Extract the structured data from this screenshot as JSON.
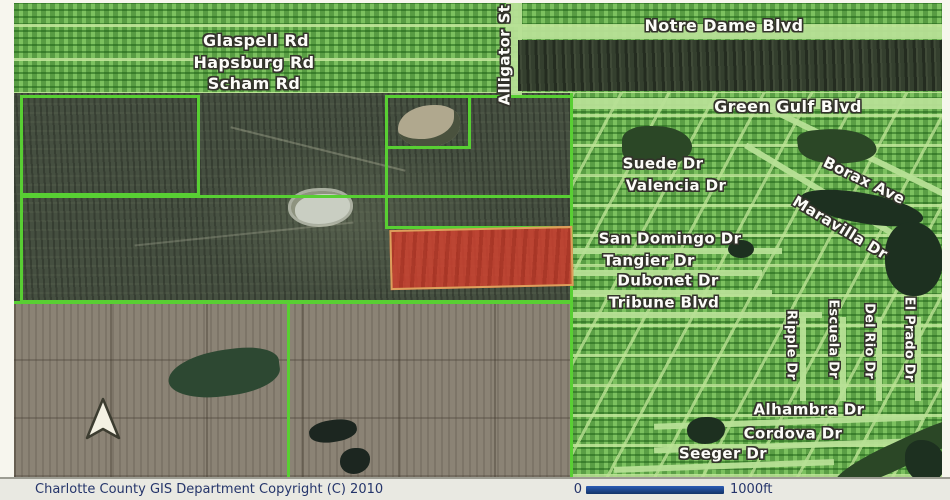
{
  "map": {
    "street_labels": {
      "glaspell": "Glaspell Rd",
      "hapsburg": "Hapsburg Rd",
      "scham": "Scham Rd",
      "alligator": "Alligator St",
      "notre_dame": "Notre Dame Blvd",
      "green_gulf": "Green Gulf Blvd",
      "suede": "Suede Dr",
      "valencia": "Valencia Dr",
      "borax": "Borax Ave",
      "maravilla": "Maravilla Dr",
      "san_domingo": "San Domingo Dr",
      "tangier": "Tangier Dr",
      "dubonet": "Dubonet Dr",
      "tribune": "Tribune Blvd",
      "ripple": "Ripple Dr",
      "escuela": "Escuela Dr",
      "del_rio": "Del Rio Dr",
      "el_prado": "El Prado Dr",
      "alhambra": "Alhambra Dr",
      "cordova": "Cordova Dr",
      "seeger": "Seeger Dr"
    },
    "icons": {
      "north_arrow": "north-arrow-triangle"
    },
    "colors": {
      "selected_parcel_fill": "#d5422f",
      "selected_parcel_border": "#dd9f5c",
      "parcel_boundary": "#58cf33",
      "residential_grid": "#7cc15f"
    }
  },
  "footer": {
    "copyright": "Charlotte County GIS Department Copyright (C) 2010",
    "scale_start": "0",
    "scale_end": "1000ft",
    "scalebar_color": "#1d4a9e"
  }
}
